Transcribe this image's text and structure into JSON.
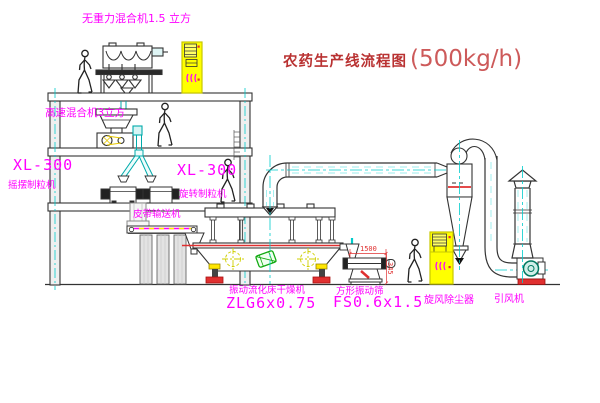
{
  "title": {
    "text": "农药生产线流程图",
    "capacity": "(500kg/h)"
  },
  "labels": {
    "zero_gravity_mixer": "无重力混合机1.5 立方",
    "high_speed_mixer": "高速混合机3立方",
    "granulator_left_model": "XL-300",
    "granulator_left_name": "摇摆制粒机",
    "granulator_mid_model": "XL-300",
    "granulator_mid_name": "旋转制粒机",
    "belt_conveyor": "皮带输送机",
    "dryer_name": "振动流化床干燥机",
    "dryer_model": "ZLG6x0.75",
    "sieve_name": "方形振动筛",
    "sieve_model": "FS0.6x1.5",
    "cyclone": "旋风除尘器",
    "fan": "引风机"
  },
  "dimensions": {
    "sieve_length": "1500",
    "sieve_height": "345"
  },
  "colors": {
    "label_magenta": "#ff00ff",
    "title_red": "#c23b3b",
    "accent_red": "#e03030",
    "cabinet_yellow": "#ffff00",
    "centerline_cyan": "#00cccc",
    "fan_teal": "#00775f",
    "drum_green": "#11aa11"
  }
}
